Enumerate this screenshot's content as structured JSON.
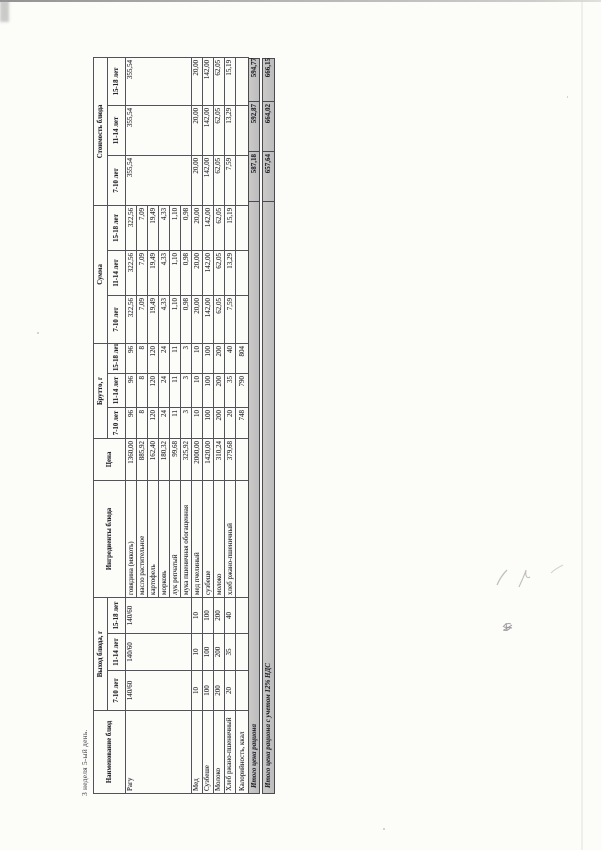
{
  "page": {
    "title": "3 неделя 5-ый день."
  },
  "table": {
    "headers": {
      "dish": "Наименование блюд",
      "output": "Выход блюда, г",
      "ingredients": "Ингредиенты блюда",
      "price": "Цена",
      "gross": "Брутто, г",
      "sum": "Сумма",
      "cost": "Стоимость блюда",
      "age_groups": [
        "7-10 лет",
        "11-14 лет",
        "15-18 лет"
      ]
    },
    "dishes": [
      {
        "name": "Рагу",
        "output": [
          "140/60",
          "140/60",
          "140/60"
        ],
        "cost": [
          "355,54",
          "355,54",
          "355,54"
        ],
        "ingredients": [
          {
            "name": "говядина (мякоть)",
            "price": "1360,00",
            "gross": [
              "96",
              "96",
              "96"
            ],
            "sum": [
              "322,56",
              "322,56",
              "322,56"
            ]
          },
          {
            "name": "масло растительное",
            "price": "885,92",
            "gross": [
              "8",
              "8",
              "8"
            ],
            "sum": [
              "7,09",
              "7,09",
              "7,09"
            ]
          },
          {
            "name": "картофель",
            "price": "162,40",
            "gross": [
              "120",
              "120",
              "120"
            ],
            "sum": [
              "19,49",
              "19,49",
              "19,49"
            ]
          },
          {
            "name": "морковь",
            "price": "180,32",
            "gross": [
              "24",
              "24",
              "24"
            ],
            "sum": [
              "4,33",
              "4,33",
              "4,33"
            ]
          },
          {
            "name": "лук репчатый",
            "price": "99,68",
            "gross": [
              "11",
              "11",
              "11"
            ],
            "sum": [
              "1,10",
              "1,10",
              "1,10"
            ]
          },
          {
            "name": "мука пшеничная обогащенная",
            "price": "325,92",
            "gross": [
              "3",
              "3",
              "3"
            ],
            "sum": [
              "0,98",
              "0,98",
              "0,98"
            ]
          }
        ]
      },
      {
        "name": "Мед",
        "output": [
          "10",
          "10",
          "10"
        ],
        "cost": [
          "20,00",
          "20,00",
          "20,00"
        ],
        "ingredients": [
          {
            "name": "мед пчелиный",
            "price": "2000,00",
            "gross": [
              "10",
              "10",
              "10"
            ],
            "sum": [
              "20,00",
              "20,00",
              "20,00"
            ]
          }
        ]
      },
      {
        "name": "Сузбеше",
        "output": [
          "100",
          "100",
          "100"
        ],
        "cost": [
          "142,00",
          "142,00",
          "142,00"
        ],
        "ingredients": [
          {
            "name": "сузбеше",
            "price": "1420,00",
            "gross": [
              "100",
              "100",
              "100"
            ],
            "sum": [
              "142,00",
              "142,00",
              "142,00"
            ]
          }
        ]
      },
      {
        "name": "Молоко",
        "output": [
          "200",
          "200",
          "200"
        ],
        "cost": [
          "62,05",
          "62,05",
          "62,05"
        ],
        "ingredients": [
          {
            "name": "молоко",
            "price": "310,24",
            "gross": [
              "200",
              "200",
              "200"
            ],
            "sum": [
              "62,05",
              "62,05",
              "62,05"
            ]
          }
        ]
      },
      {
        "name": "Хлеб ржано-пшеничный",
        "output": [
          "20",
          "35",
          "40"
        ],
        "cost": [
          "7,59",
          "13,29",
          "15,19"
        ],
        "ingredients": [
          {
            "name": "хлеб ржано-пшеничный",
            "price": "379,68",
            "gross": [
              "20",
              "35",
              "40"
            ],
            "sum": [
              "7,59",
              "13,29",
              "15,19"
            ]
          }
        ]
      }
    ],
    "calories": {
      "label": "Калорийность, ккал",
      "values": [
        "748",
        "790",
        "804"
      ]
    },
    "totals": [
      {
        "label": "Итого цена рациона",
        "values": [
          "587,18",
          "592,87",
          "594,77"
        ]
      },
      {
        "label": "Итого цена рациона с учетом 12% НДС",
        "values": [
          "657,64",
          "664,02",
          "666,15"
        ]
      }
    ]
  }
}
